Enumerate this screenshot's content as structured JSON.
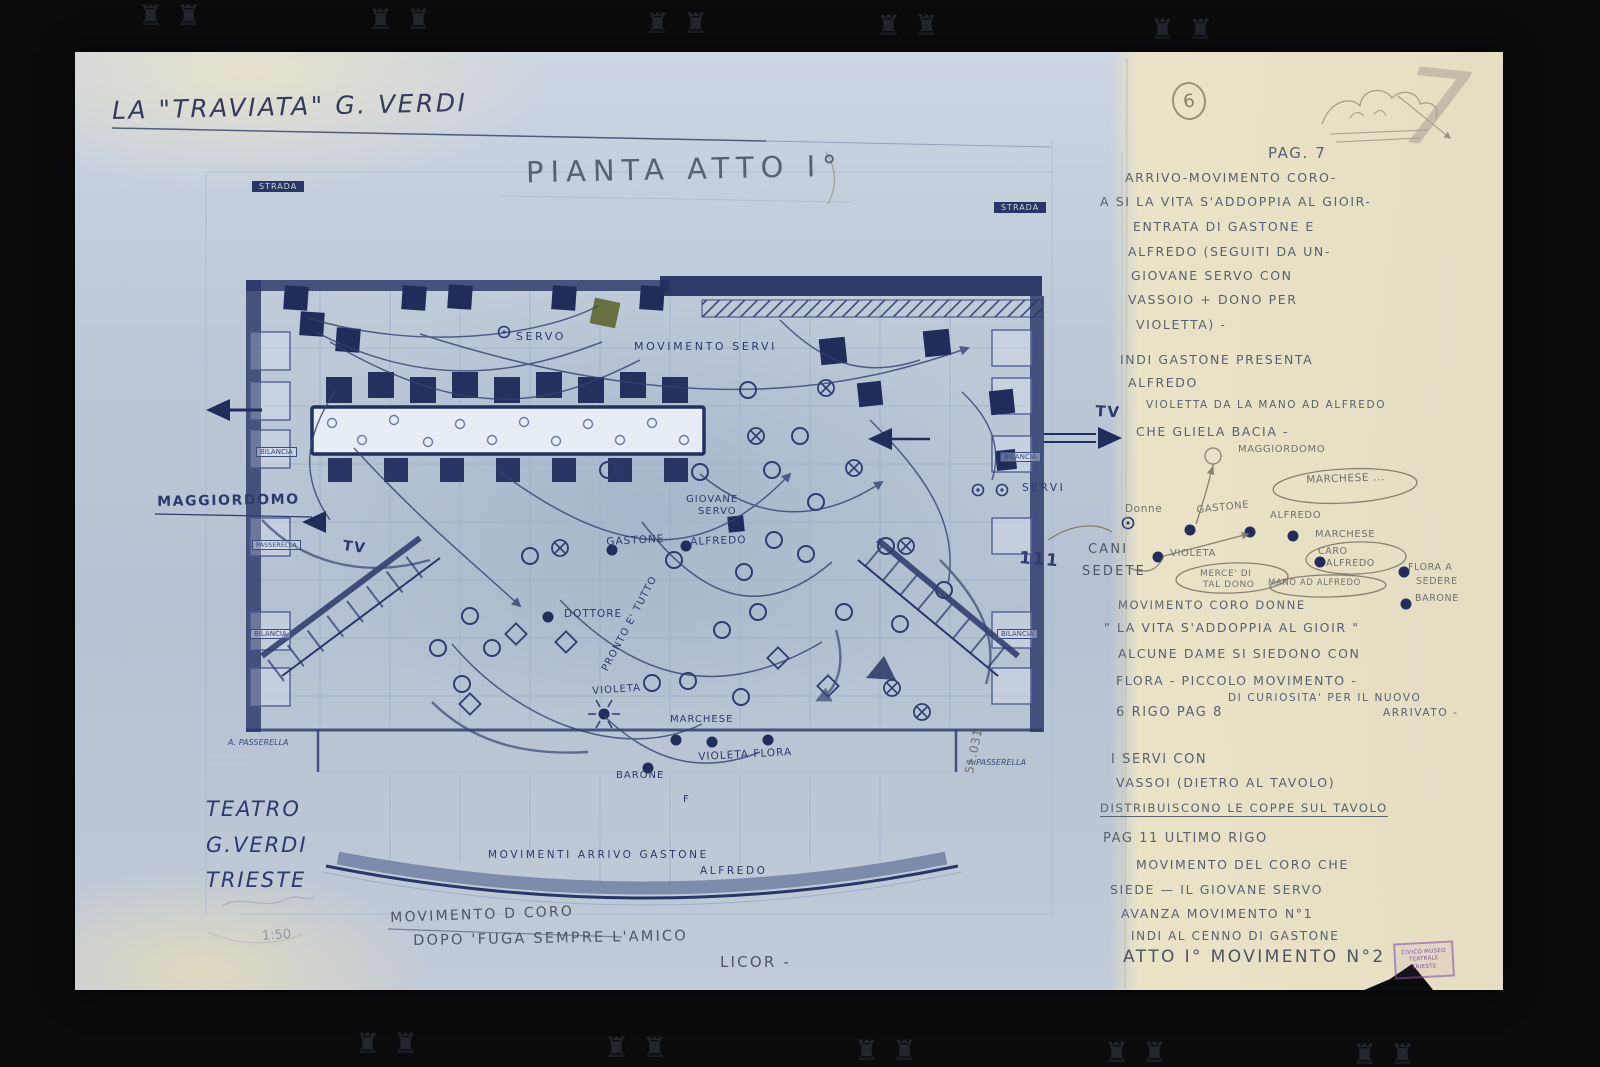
{
  "page": {
    "title": "LA \"TRAVIATA\"  G. VERDI",
    "plan_title": "PIANTA ATTO I°",
    "sheet_circle": "6",
    "corner_numeral": "7",
    "scale": "1:50",
    "theater": {
      "l1": "TEATRO",
      "l2": "G.VERDI",
      "l3": "TRIESTE"
    },
    "stamp": {
      "l1": "CIVICO MUSEO",
      "l2": "TEATRALE",
      "l3": "TRIESTE"
    }
  },
  "notes": [
    {
      "n": "page-ref",
      "t": "PAG. 7",
      "x": 1268,
      "y": 144,
      "s": 15
    },
    {
      "t": "ARRIVO-MOVIMENTO CORO-",
      "x": 1125,
      "y": 170
    },
    {
      "t": "A SI LA VITA S'ADDOPPIA AL GIOIR-",
      "x": 1100,
      "y": 194
    },
    {
      "t": "ENTRATA DI GASTONE E",
      "x": 1133,
      "y": 219
    },
    {
      "t": "ALFREDO (SEGUITI DA UN-",
      "x": 1128,
      "y": 244
    },
    {
      "t": "GIOVANE SERVO CON",
      "x": 1131,
      "y": 268
    },
    {
      "t": "VASSOIO + DONO PER",
      "x": 1128,
      "y": 292
    },
    {
      "t": "VIOLETTA) -",
      "x": 1136,
      "y": 317
    },
    {
      "t": "INDI GASTONE PRESENTA",
      "x": 1120,
      "y": 352
    },
    {
      "t": "ALFREDO",
      "x": 1128,
      "y": 375
    },
    {
      "t": "VIOLETTA DA LA MANO AD ALFREDO",
      "x": 1146,
      "y": 399,
      "s": 10.5
    },
    {
      "t": "CHE GLIELA BACIA -",
      "x": 1136,
      "y": 424
    },
    {
      "t": "MOVIMENTO CORO DONNE",
      "x": 1118,
      "y": 598,
      "s": 11.5
    },
    {
      "t": "\" LA VITA S'ADDOPPIA AL GIOIR \"",
      "x": 1104,
      "y": 620
    },
    {
      "t": "ALCUNE DAME SI SIEDONO CON",
      "x": 1118,
      "y": 646
    },
    {
      "t": "FLORA - PICCOLO MOVIMENTO -",
      "x": 1116,
      "y": 673
    },
    {
      "t": "DI CURIOSITA' PER IL NUOVO",
      "x": 1228,
      "y": 692,
      "s": 10.5
    },
    {
      "t": "6 RIGO PAG 8",
      "x": 1116,
      "y": 705,
      "s": 13
    },
    {
      "t": "ARRIVATO -",
      "x": 1383,
      "y": 707,
      "s": 10.5
    },
    {
      "t": "I SERVI CON",
      "x": 1111,
      "y": 752,
      "s": 13
    },
    {
      "t": "VASSOI (DIETRO AL TAVOLO)",
      "x": 1116,
      "y": 775
    },
    {
      "t": "DISTRIBUISCONO LE COPPE SUL TAVOLO",
      "x": 1100,
      "y": 801,
      "s": 11.5,
      "u": 1
    },
    {
      "t": "PAG 11  ULTIMO RIGO",
      "x": 1103,
      "y": 831,
      "s": 13
    },
    {
      "t": "MOVIMENTO DEL CORO CHE",
      "x": 1136,
      "y": 857
    },
    {
      "t": "SIEDE — IL GIOVANE SERVO",
      "x": 1110,
      "y": 882
    },
    {
      "t": "AVANZA MOVIMENTO N°1",
      "x": 1121,
      "y": 906
    },
    {
      "t": "INDI AL CENNO DI GASTONE",
      "x": 1131,
      "y": 929,
      "s": 12
    },
    {
      "n": "atto-movimento-line",
      "t": "ATTO I° MOVIMENTO N°2",
      "x": 1123,
      "y": 947,
      "cls": "big"
    }
  ],
  "plan_labels": [
    {
      "n": "label-strada-left",
      "t": "STRADA",
      "x": 252,
      "y": 181,
      "s": 8,
      "cls": "boxdark"
    },
    {
      "n": "label-strada-right",
      "t": "STRADA",
      "x": 994,
      "y": 202,
      "s": 8,
      "cls": "boxdark"
    },
    {
      "n": "label-bilancia-left-1",
      "t": "BILANCIA",
      "x": 256,
      "y": 447,
      "s": 7,
      "cls": "boxlite"
    },
    {
      "n": "label-passerella-left",
      "t": "PASSERELLA",
      "x": 252,
      "y": 540,
      "s": 6.5,
      "cls": "boxlite"
    },
    {
      "n": "label-bilancia-left-2",
      "t": "BILANCIA",
      "x": 250,
      "y": 629,
      "s": 7,
      "cls": "boxlite"
    },
    {
      "n": "label-bilancia-right-1",
      "t": "BILANCIA",
      "x": 1000,
      "y": 452,
      "s": 7,
      "cls": "boxlite"
    },
    {
      "n": "label-bilancia-right-2",
      "t": "BILANCIA",
      "x": 997,
      "y": 629,
      "s": 7,
      "cls": "boxlite"
    },
    {
      "n": "label-passerella-bottom-left",
      "t": "A. PASSERELLA",
      "x": 228,
      "y": 738,
      "s": 8,
      "cls": "tiny"
    },
    {
      "n": "label-passerella-bottom-right",
      "t": "A.PASSERELLA",
      "x": 968,
      "y": 758,
      "s": 8,
      "cls": "tiny"
    },
    {
      "n": "label-servo-top",
      "t": "SERVO",
      "x": 516,
      "y": 330,
      "s": 11,
      "cls": "ink sp2"
    },
    {
      "n": "label-movimento-servi",
      "t": "MOVIMENTO SERVI",
      "x": 634,
      "y": 340,
      "s": 11,
      "cls": "ink sp2"
    },
    {
      "n": "label-maggiordomo-left",
      "t": "MAGGIORDOMO",
      "x": 157,
      "y": 494,
      "s": 14,
      "cls": "inkbig",
      "r": -1
    },
    {
      "n": "label-tv-left",
      "t": "TV",
      "x": 344,
      "y": 538,
      "s": 14,
      "cls": "inkbig",
      "r": 8
    },
    {
      "n": "label-tv-right",
      "t": "TV",
      "x": 1096,
      "y": 402,
      "s": 15,
      "cls": "inkbig",
      "r": 3
    },
    {
      "n": "label-giovane",
      "t": "GIOVANE",
      "x": 686,
      "y": 494,
      "s": 10,
      "cls": "ink"
    },
    {
      "n": "label-giovane-servo",
      "t": "SERVO",
      "x": 698,
      "y": 506,
      "s": 10,
      "cls": "ink"
    },
    {
      "n": "label-gastone",
      "t": "GASTONE",
      "x": 606,
      "y": 536,
      "s": 10.5,
      "cls": "ink",
      "r": -3
    },
    {
      "n": "label-alfredo",
      "t": "ALFREDO",
      "x": 690,
      "y": 536,
      "s": 10.5,
      "cls": "ink",
      "r": -2
    },
    {
      "n": "label-dottore",
      "t": "DOTTORE",
      "x": 564,
      "y": 608,
      "s": 10.5,
      "cls": "ink"
    },
    {
      "n": "label-pronto-e-tutto",
      "t": "PRONTO E' TUTTO",
      "x": 600,
      "y": 668,
      "s": 10,
      "cls": "ink",
      "r": -62
    },
    {
      "n": "label-violetta-stage",
      "t": "VIOLETA",
      "x": 592,
      "y": 686,
      "s": 10,
      "cls": "ink",
      "r": -4
    },
    {
      "n": "label-marchese-stage",
      "t": "MARCHESE",
      "x": 670,
      "y": 714,
      "s": 10,
      "cls": "ink"
    },
    {
      "n": "label-violetta-flora",
      "t": "VIOLETA FLORA",
      "x": 698,
      "y": 751,
      "s": 10.5,
      "cls": "ink",
      "r": -3
    },
    {
      "n": "label-barone-stage",
      "t": "BARONE",
      "x": 616,
      "y": 770,
      "s": 10,
      "cls": "ink"
    },
    {
      "n": "label-servi-right",
      "t": "SERVI",
      "x": 1022,
      "y": 482,
      "s": 10.5,
      "cls": "ink sp2"
    },
    {
      "n": "label-f-mark",
      "t": "F",
      "x": 683,
      "y": 794,
      "s": 10,
      "cls": "ink"
    },
    {
      "n": "label-tally",
      "t": "111",
      "x": 1020,
      "y": 548,
      "s": 17,
      "cls": "inkbig",
      "r": 5
    },
    {
      "n": "label-numeral-vertical",
      "t": "51.031",
      "x": 962,
      "y": 772,
      "s": 12,
      "cls": "pencil",
      "r": -78
    },
    {
      "n": "label-movimenti-arrivo",
      "t": "MOVIMENTI ARRIVO GASTONE",
      "x": 488,
      "y": 849,
      "s": 10.5,
      "cls": "ink sp2"
    },
    {
      "n": "label-arrivo-alfredo",
      "t": "ALFREDO",
      "x": 700,
      "y": 865,
      "s": 10.5,
      "cls": "ink sp2"
    },
    {
      "n": "label-movimento-coro",
      "t": "MOVIMENTO D CORO",
      "x": 390,
      "y": 910,
      "s": 14,
      "cls": "pencilbig",
      "r": -2
    },
    {
      "n": "label-dopo-fuga",
      "t": "DOPO 'FUGA SEMPRE L'AMICO",
      "x": 413,
      "y": 933,
      "s": 14.5,
      "cls": "pencilbig",
      "r": -1
    },
    {
      "n": "label-licor",
      "t": "LICOR -",
      "x": 720,
      "y": 953,
      "s": 15,
      "cls": "pencilbig"
    },
    {
      "n": "sketch-maggiordomo",
      "t": "MAGGIORDOMO",
      "x": 1238,
      "y": 444,
      "s": 10,
      "cls": "pencil"
    },
    {
      "n": "sketch-marchese-1",
      "t": "MARCHESE ...",
      "x": 1306,
      "y": 474,
      "s": 10.5,
      "cls": "pencil",
      "r": -2
    },
    {
      "n": "sketch-donne",
      "t": "Donne",
      "x": 1125,
      "y": 503,
      "s": 10.5,
      "cls": "pencil"
    },
    {
      "n": "sketch-gastone",
      "t": "GASTONE",
      "x": 1196,
      "y": 505,
      "s": 10,
      "cls": "pencil",
      "r": -6
    },
    {
      "n": "sketch-alfredo",
      "t": "ALFREDO",
      "x": 1270,
      "y": 510,
      "s": 10,
      "cls": "pencil"
    },
    {
      "n": "sketch-marchese-2",
      "t": "MARCHESE",
      "x": 1315,
      "y": 529,
      "s": 10,
      "cls": "pencil"
    },
    {
      "n": "sketch-cani",
      "t": "CANI",
      "x": 1088,
      "y": 542,
      "s": 13,
      "cls": "pencilbig"
    },
    {
      "n": "sketch-sedete",
      "t": "SEDETE",
      "x": 1082,
      "y": 564,
      "s": 13,
      "cls": "pencilbig"
    },
    {
      "n": "sketch-violetta",
      "t": "VIOLETA",
      "x": 1170,
      "y": 548,
      "s": 10,
      "cls": "pencil"
    },
    {
      "n": "sketch-caro",
      "t": "CARO",
      "x": 1318,
      "y": 546,
      "s": 9.5,
      "cls": "pencil"
    },
    {
      "n": "sketch-caro-alfredo",
      "t": "ALFREDO",
      "x": 1326,
      "y": 558,
      "s": 9.5,
      "cls": "pencil"
    },
    {
      "n": "sketch-merce-di",
      "t": "MERCE' DI",
      "x": 1200,
      "y": 569,
      "s": 9,
      "cls": "pencil"
    },
    {
      "n": "sketch-tal-dono",
      "t": "TAL DONO",
      "x": 1203,
      "y": 580,
      "s": 9,
      "cls": "pencil"
    },
    {
      "n": "sketch-mano-ad-alfredo",
      "t": "MANO AD ALFREDO",
      "x": 1268,
      "y": 578,
      "s": 8.5,
      "cls": "pencil"
    },
    {
      "n": "sketch-flora-a",
      "t": "FLORA A",
      "x": 1408,
      "y": 562,
      "s": 9.5,
      "cls": "pencil"
    },
    {
      "n": "sketch-sedere",
      "t": "SEDERE",
      "x": 1416,
      "y": 576,
      "s": 9.5,
      "cls": "pencil"
    },
    {
      "n": "sketch-barone",
      "t": "BARONE",
      "x": 1415,
      "y": 593,
      "s": 9.5,
      "cls": "pencil"
    }
  ],
  "crowns": {
    "glyph": "♜",
    "top": [
      [
        138,
        2
      ],
      [
        176,
        2
      ],
      [
        368,
        6
      ],
      [
        406,
        6
      ],
      [
        645,
        10
      ],
      [
        683,
        10
      ],
      [
        876,
        12
      ],
      [
        914,
        12
      ],
      [
        1150,
        16
      ],
      [
        1188,
        16
      ]
    ],
    "bottom": [
      [
        355,
        1030
      ],
      [
        393,
        1030
      ],
      [
        604,
        1034
      ],
      [
        642,
        1034
      ],
      [
        854,
        1037
      ],
      [
        892,
        1037
      ],
      [
        1104,
        1039
      ],
      [
        1142,
        1039
      ],
      [
        1352,
        1041
      ],
      [
        1390,
        1041
      ]
    ]
  }
}
